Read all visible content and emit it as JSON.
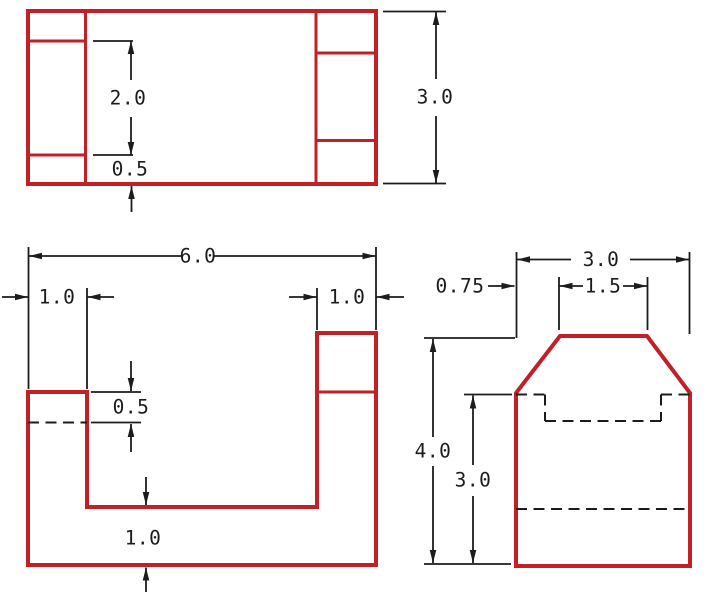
{
  "drawing": {
    "title": "three-view orthographic dimensioned drawing",
    "background_color": "#ffffff",
    "part_line_color": "#c12126",
    "dimension_line_color": "#1c1c1c",
    "views": {
      "top": {
        "name": "top view",
        "dims": {
          "inner_depth": "2.0",
          "edge_offset": "0.5",
          "total_depth": "3.0"
        }
      },
      "front": {
        "name": "front view",
        "dims": {
          "total_width": "6.0",
          "left_wall_width": "1.0",
          "right_wall_width": "1.0",
          "step_depth": "0.5",
          "base_height": "1.0"
        }
      },
      "side": {
        "name": "side view",
        "dims": {
          "total_width": "3.0",
          "chamfer_width": "0.75",
          "top_flat_width": "1.5",
          "total_height": "4.0",
          "shoulder_height": "3.0"
        }
      }
    }
  }
}
